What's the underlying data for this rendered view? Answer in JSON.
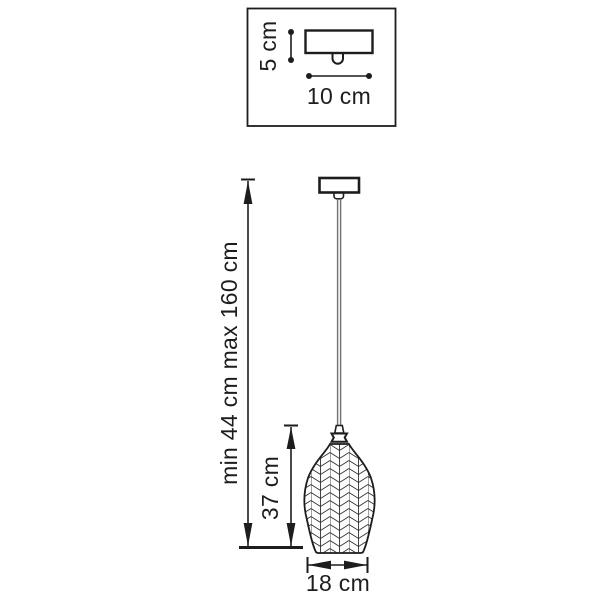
{
  "colors": {
    "line": "#1d1d1d",
    "text": "#1d1d1d",
    "cord": "#6f6f6f",
    "background": "#ffffff"
  },
  "detail_inset": {
    "height_label": "5 cm",
    "width_label": "10 cm"
  },
  "pendant": {
    "overall_height_label": "min 44 cm max 160 cm",
    "shade_height_label": "37 cm",
    "shade_width_label": "18 cm"
  }
}
